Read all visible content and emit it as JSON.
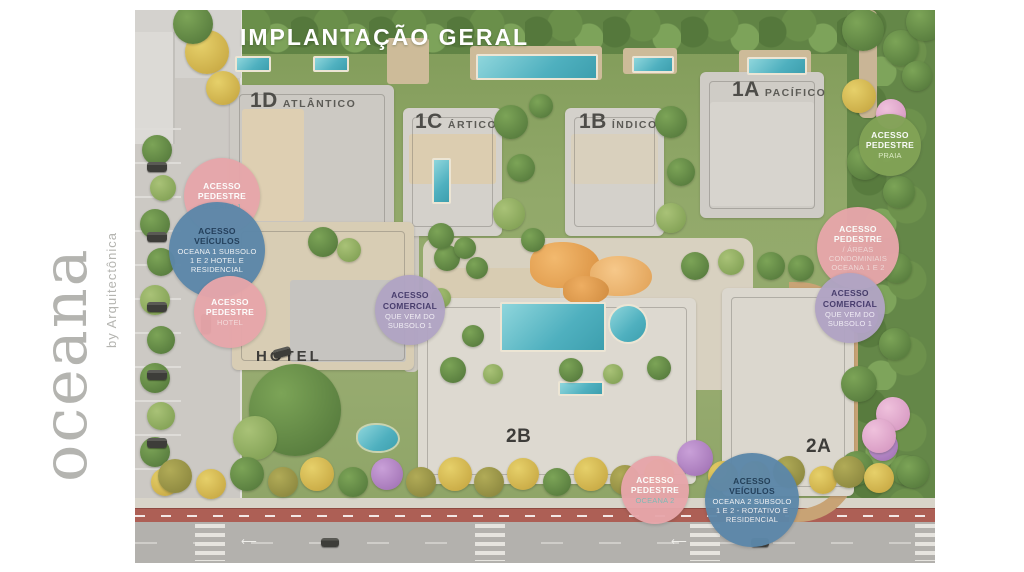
{
  "logo": {
    "brand": "oceana",
    "byline": "by Arquitectônica",
    "color": "#b4b4b0"
  },
  "plan": {
    "title": "IMPLANTAÇÃO GERAL",
    "title_color": "#ffffff",
    "buildings": [
      {
        "code": "1D",
        "name": "ATLÂNTICO"
      },
      {
        "code": "1C",
        "name": "ÁRTICO"
      },
      {
        "code": "1B",
        "name": "ÍNDICO"
      },
      {
        "code": "1A",
        "name": "PACÍFICO"
      },
      {
        "code": "HOTEL",
        "name": ""
      },
      {
        "code": "2B",
        "name": ""
      },
      {
        "code": "2A",
        "name": ""
      }
    ],
    "badges": [
      {
        "title": "ACESSO PEDESTRE",
        "subtitle": "OCEANA 1",
        "bg": "#e7a6aa",
        "title_color": "#ffffff",
        "subtitle_color": "#7db8b5"
      },
      {
        "title": "ACESSO VEÍCULOS",
        "subtitle": "OCEANA 1 SUBSOLO 1 E 2 HOTEL E RESIDENCIAL",
        "bg": "#5c87a9",
        "title_color": "#1c3a57",
        "subtitle_color": "#eef2f6"
      },
      {
        "title": "ACESSO PEDESTRE",
        "subtitle": "HOTEL",
        "bg": "#e7a6aa",
        "title_color": "#ffffff",
        "subtitle_color": "#f4d9da"
      },
      {
        "title": "ACESSO COMERCIAL",
        "subtitle": "QUE VEM DO SUBSOLO 1",
        "bg": "#b1a4c4",
        "title_color": "#43386a",
        "subtitle_color": "#f1eef6"
      },
      {
        "title": "ACESSO PEDESTRE",
        "subtitle": "PRAIA",
        "bg": "#82a356",
        "title_color": "#ffffff",
        "subtitle_color": "#e0eec9"
      },
      {
        "title": "ACESSO PEDESTRE",
        "subtitle": "/ ÁREAS CONDOMINIAIS OCEANA 1 E 2",
        "bg": "#e7a6aa",
        "title_color": "#ffffff",
        "subtitle_color": "#f6e3e3"
      },
      {
        "title": "ACESSO COMERCIAL",
        "subtitle": "QUE VEM DO SUBSOLO 1",
        "bg": "#b1a4c4",
        "title_color": "#43386a",
        "subtitle_color": "#f1eef6"
      },
      {
        "title": "ACESSO PEDESTRE",
        "subtitle": "OCEANA 2",
        "bg": "#e7a6aa",
        "title_color": "#ffffff",
        "subtitle_color": "#7db8b5"
      },
      {
        "title": "ACESSO VEÍCULOS",
        "subtitle": "OCEANA 2 SUBSOLO 1 E 2 - ROTATIVO E RESIDENCIAL",
        "bg": "#5c87a9",
        "title_color": "#1c3a57",
        "subtitle_color": "#eef2f6"
      }
    ]
  }
}
